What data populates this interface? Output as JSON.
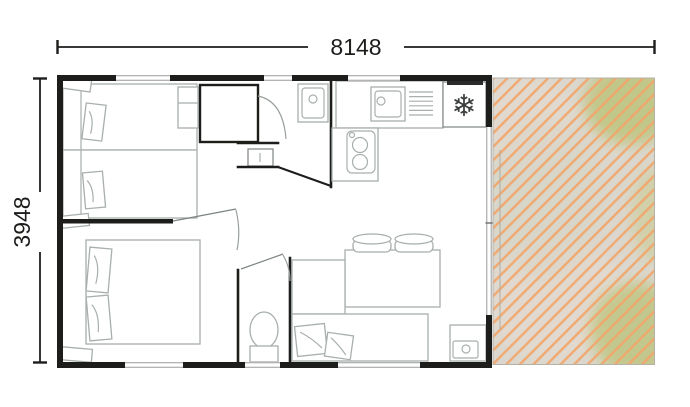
{
  "plan": {
    "dimensions": {
      "width": "8148",
      "height": "3948"
    },
    "icons": {
      "snowflake": "❄"
    },
    "colors": {
      "wall": "#1d1d1b",
      "dimension": "#1d1d1b",
      "furniture": "#a8afad",
      "furniture_dark": "#7d8482",
      "door": "#9aa09e",
      "glass": "#9b9b9b",
      "hood": "#2b2b2b",
      "hatch_line": "#f2a56b",
      "terrace_base": "#dbd7ce",
      "terrace_green_1": "#bdc47e",
      "terrace_green_2": "#c9cb90",
      "terrace_warm": "#e6dbd0"
    }
  }
}
